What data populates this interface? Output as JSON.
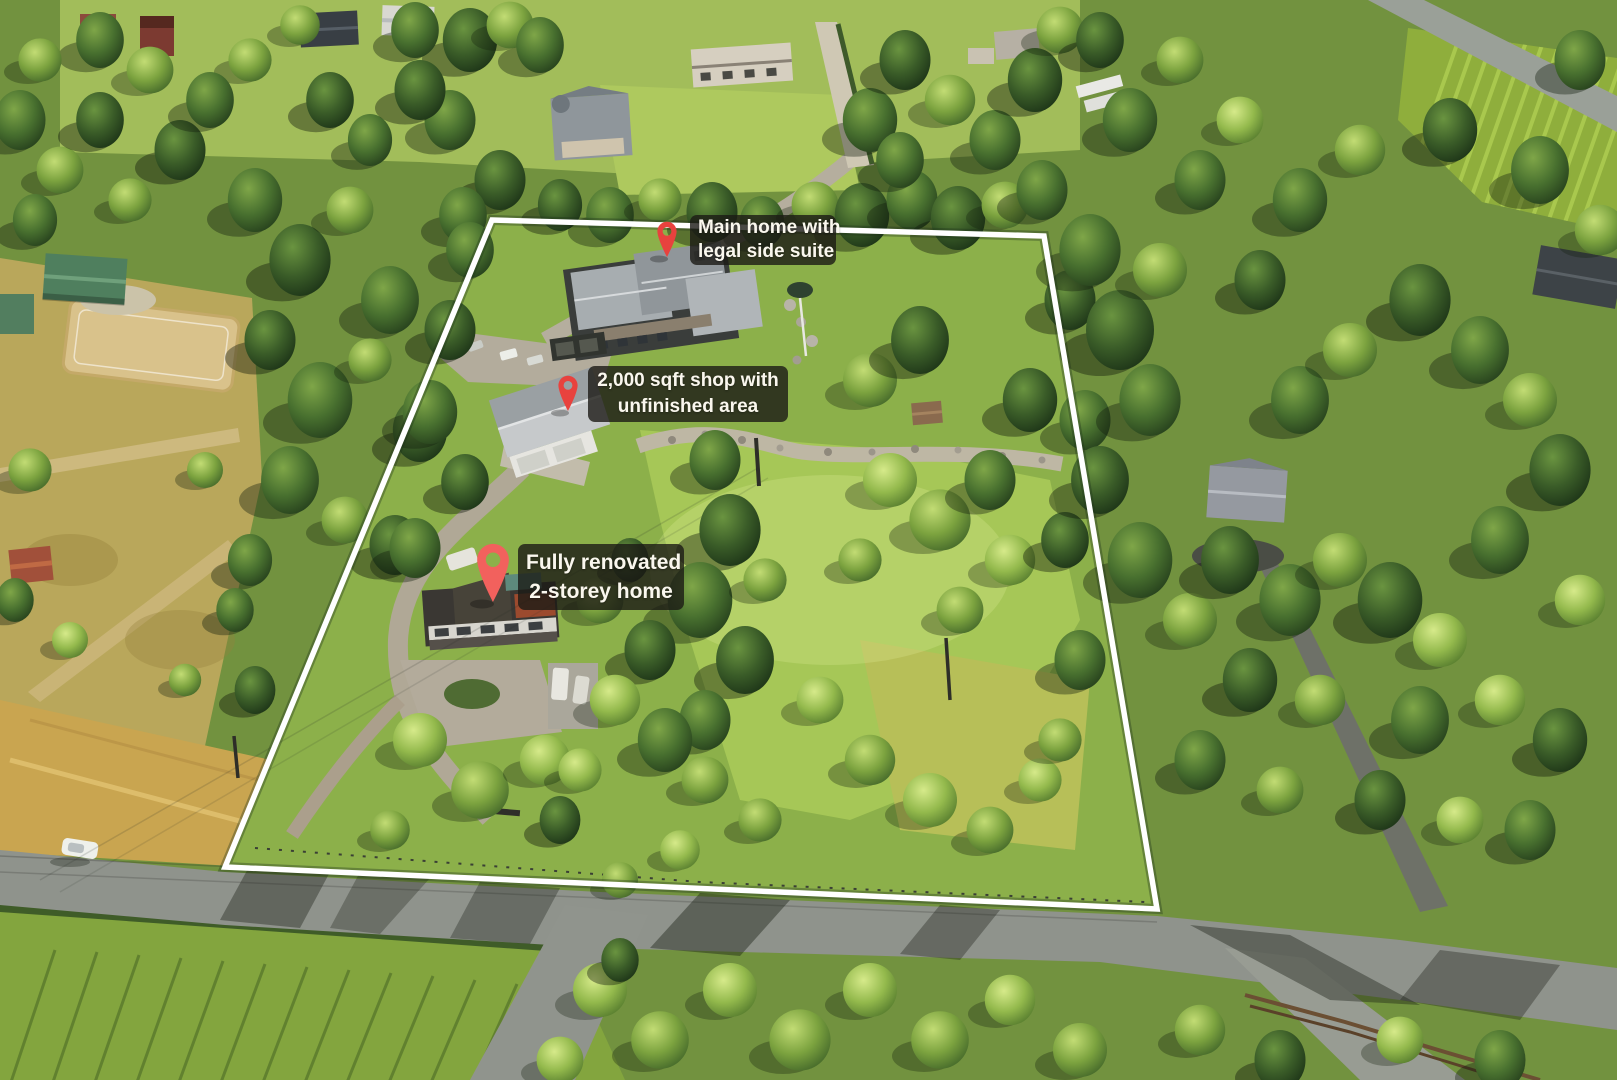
{
  "annotations": [
    {
      "id": "main-home",
      "icon": "map-pin-icon",
      "line1": "Main home with",
      "line2": "legal side suite",
      "pin": {
        "color": "#e8423e"
      }
    },
    {
      "id": "shop",
      "icon": "map-pin-icon",
      "line1": "2,000 sqft shop with",
      "line2": "unfinished area",
      "pin": {
        "color": "#e8423e"
      }
    },
    {
      "id": "renovated-home",
      "icon": "map-pin-icon",
      "line1": "Fully renovated",
      "line2": "2-storey home",
      "pin": {
        "color": "#f2615d"
      }
    }
  ],
  "boundary": {
    "color": "#ffffff",
    "points": "492,220 1044,236 1157,909 225,867"
  },
  "palette": {
    "label_bg": "rgba(27,26,21,0.8)",
    "label_text": "#faf7ee",
    "boundary_white": "#ffffff",
    "pin_red": "#e8423e",
    "pin_red_light": "#f2615d",
    "forest_dark": "#2a4520",
    "grass_bright": "#a9c958",
    "field_gold": "#c9a550",
    "road_gray": "#8f938c"
  }
}
